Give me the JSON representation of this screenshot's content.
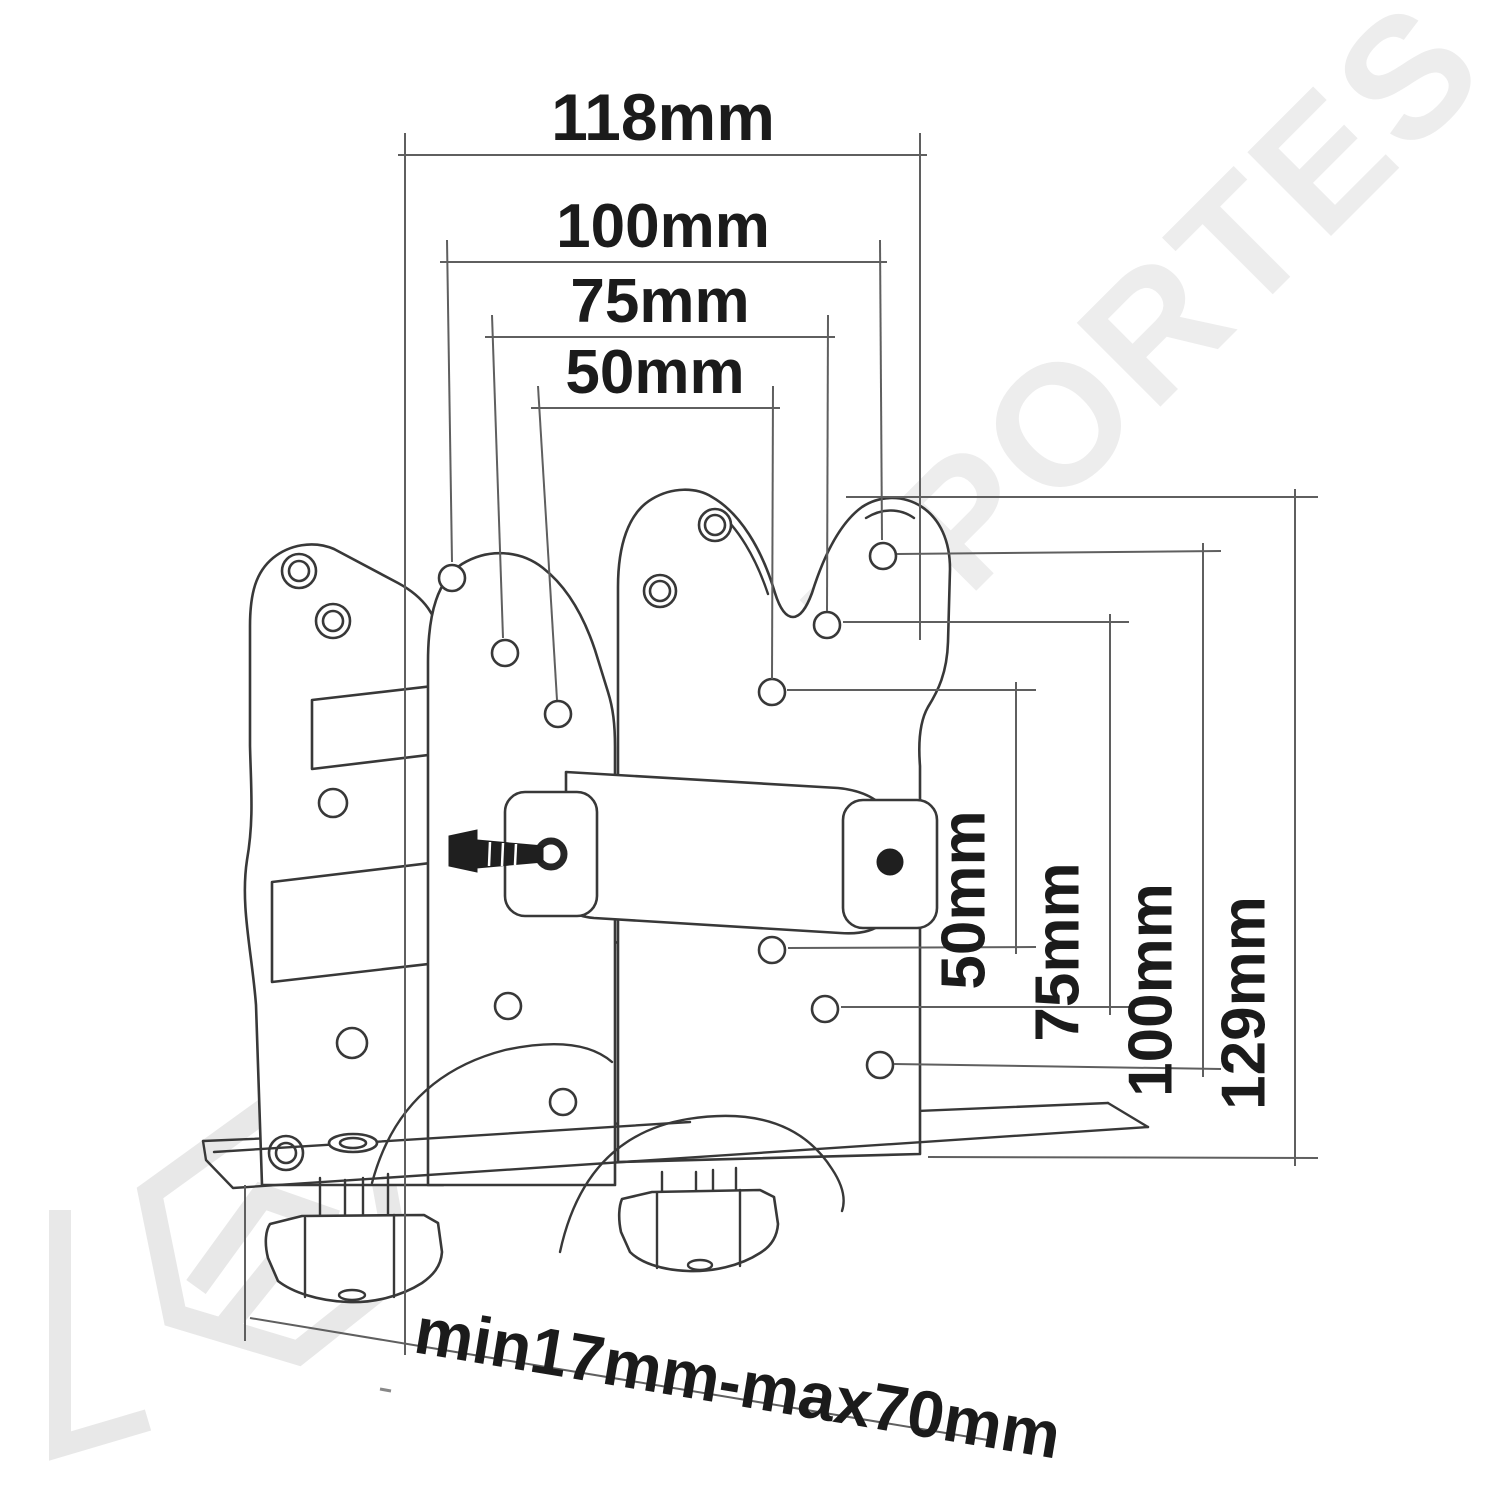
{
  "watermark": {
    "text": "ABC SUPORTES",
    "color": "#ededed"
  },
  "drawing": {
    "background": "#ffffff",
    "line_color": "#383838",
    "dimension_line_color": "#5f5f5f",
    "label_color": "#1b1b1b"
  },
  "dimensions": {
    "top": [
      {
        "label": "118mm",
        "value": 118,
        "unit": "mm"
      },
      {
        "label": "100mm",
        "value": 100,
        "unit": "mm"
      },
      {
        "label": "75mm",
        "value": 75,
        "unit": "mm"
      },
      {
        "label": "50mm",
        "value": 50,
        "unit": "mm"
      }
    ],
    "right": [
      {
        "label": "50mm",
        "value": 50,
        "unit": "mm"
      },
      {
        "label": "75mm",
        "value": 75,
        "unit": "mm"
      },
      {
        "label": "100mm",
        "value": 100,
        "unit": "mm"
      },
      {
        "label": "129mm",
        "value": 129,
        "unit": "mm"
      }
    ],
    "bottom": {
      "label": "min17mm-max70mm",
      "min_value": 17,
      "max_value": 70,
      "unit": "mm"
    }
  }
}
